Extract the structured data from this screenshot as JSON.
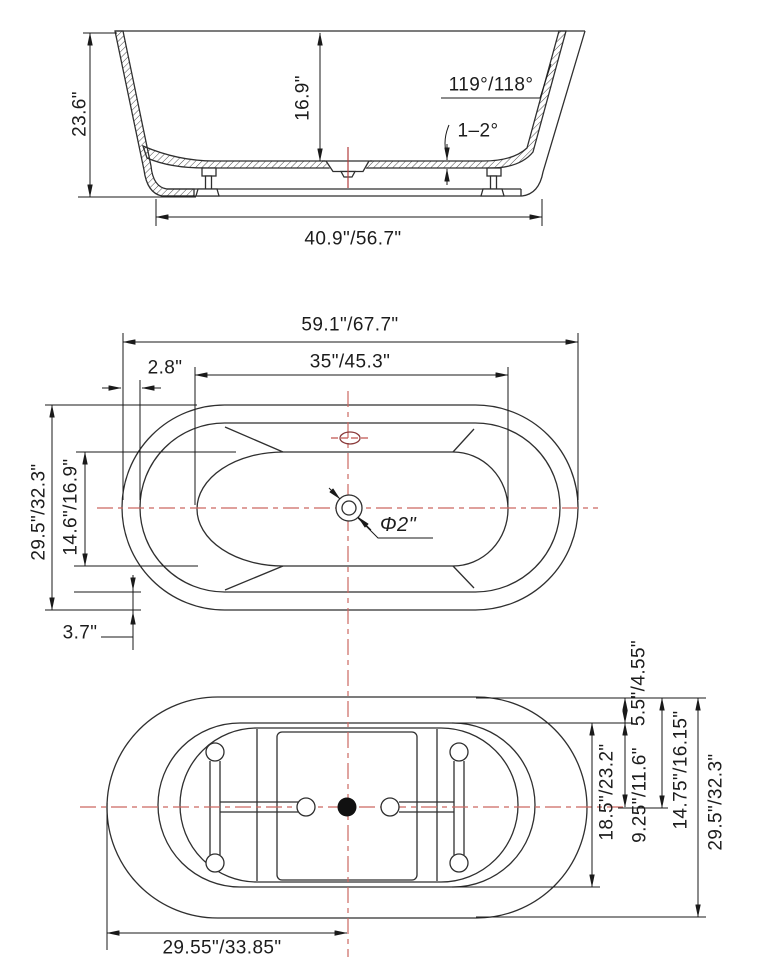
{
  "drawing": {
    "title": "bathtub-dimension-drawing",
    "front_view": {
      "overall_height": "23.6\"",
      "interior_depth": "16.9\"",
      "wall_angle": "119°/118°",
      "bottom_slope": "1–2°",
      "base_length": "40.9\"/56.7\""
    },
    "plan_view": {
      "overall_length": "59.1\"/67.7\"",
      "interior_length": "35\"/45.3\"",
      "rim_width_end": "2.8\"",
      "overall_width": "29.5\"/32.3\"",
      "interior_width": "14.6\"/16.9\"",
      "rim_width_side": "3.7\"",
      "drain_diameter": "Φ2\""
    },
    "bottom_view": {
      "deck_offset": "5.5\"/4.55\"",
      "base_width": "18.5\"/23.2\"",
      "half_base_width": "9.25\"/11.6\"",
      "edge_to_center": "14.75\"/16.15\"",
      "overall_width": "29.5\"/32.3\"",
      "half_length": "29.55\"/33.85\""
    },
    "colors": {
      "line": "#2f2f2f",
      "dimension": "#1a1a1a",
      "centerline_red": "#cc6862",
      "accent_red": "#b23d3d"
    }
  }
}
